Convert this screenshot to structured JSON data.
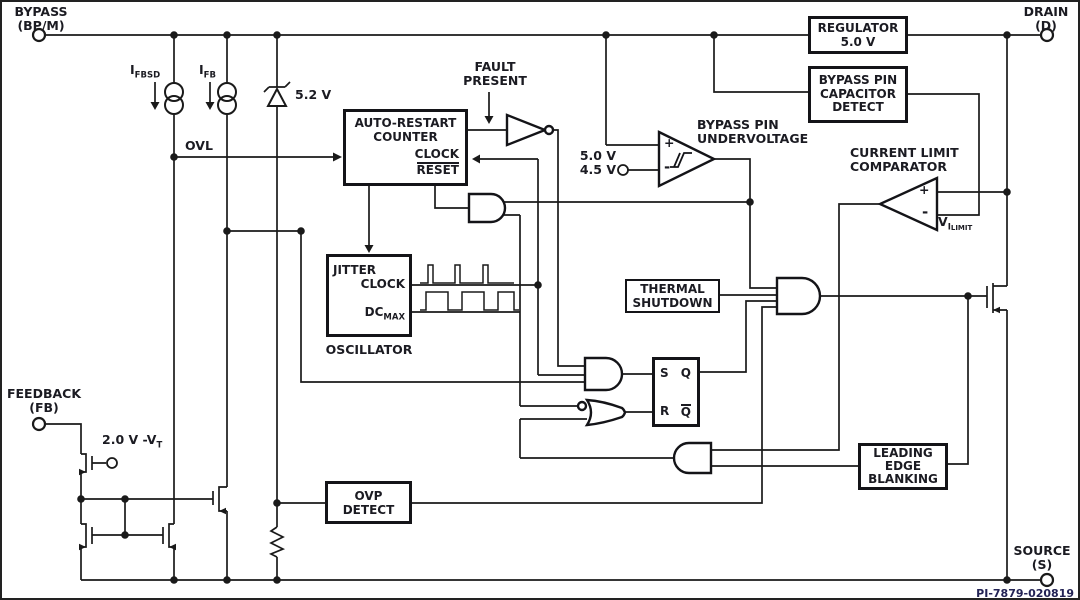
{
  "code": "PI-7879-020819",
  "terminals": {
    "bypass": [
      "BYPASS",
      "(BP/M)"
    ],
    "drain": [
      "DRAIN",
      "(D)"
    ],
    "feedback": [
      "FEEDBACK",
      "(FB)"
    ],
    "source": [
      "SOURCE",
      "(S)"
    ]
  },
  "blocks": {
    "regulator": [
      "REGULATOR",
      "5.0 V"
    ],
    "cap_detect": [
      "BYPASS PIN",
      "CAPACITOR",
      "DETECT"
    ],
    "auto_restart": {
      "l1": "AUTO-RESTART",
      "l2": "COUNTER",
      "clock": "CLOCK",
      "reset": "RESET"
    },
    "oscillator": {
      "jitter": "JITTER",
      "clock": "CLOCK",
      "dc": "DC",
      "dc_sub": "MAX",
      "caption": "OSCILLATOR"
    },
    "thermal": [
      "THERMAL",
      "SHUTDOWN"
    ],
    "leb": [
      "LEADING",
      "EDGE",
      "BLANKING"
    ],
    "ovp": [
      "OVP",
      "DETECT"
    ],
    "latch": {
      "s": "S",
      "q": "Q",
      "r": "R",
      "qbar": "Q"
    }
  },
  "labels": {
    "fault": [
      "FAULT",
      "PRESENT"
    ],
    "bypass_uv": [
      "BYPASS PIN",
      "UNDERVOLTAGE"
    ],
    "cl_comp": [
      "CURRENT LIMIT",
      "COMPARATOR"
    ],
    "ifbsd": {
      "main": "I",
      "sub": "FBSD"
    },
    "ifb": {
      "main": "I",
      "sub": "FB"
    },
    "zener": "5.2 V",
    "ovl": "OVL",
    "uv_hi": "5.0 V",
    "uv_lo": "4.5 V",
    "vilimit": {
      "main": "V",
      "sub": "I",
      "subsub": "LIMIT"
    },
    "vt": {
      "main": "2.0 V -V",
      "sub": "T"
    },
    "plus": "+",
    "minus": "-"
  },
  "colors": {
    "line": "#1a1a1a",
    "text": "#1b1b22",
    "code": "#232355"
  }
}
